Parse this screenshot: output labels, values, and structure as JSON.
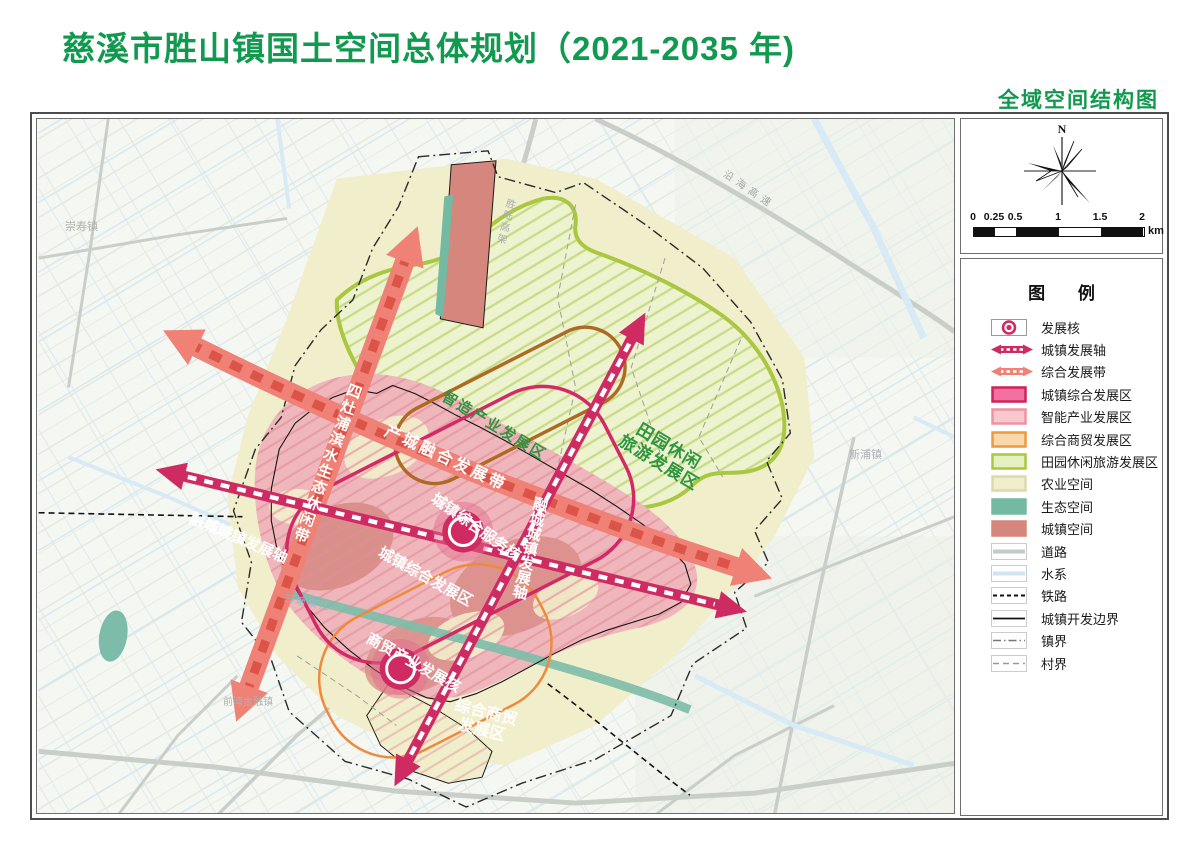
{
  "page": {
    "title": "慈溪市胜山镇国土空间总体规划（2021-2035 年)",
    "subtitle": "全域空间结构图",
    "title_color": "#10994f"
  },
  "panel": {
    "north_label": "N",
    "scale": {
      "ticks": [
        "0",
        "0.25",
        "0.5",
        "1",
        "1.5",
        "2"
      ],
      "tick_px": [
        0,
        21,
        42,
        85,
        127,
        169
      ],
      "segments": [
        {
          "w": 21,
          "c": "#111111"
        },
        {
          "w": 21,
          "c": "#ffffff"
        },
        {
          "w": 43,
          "c": "#111111"
        },
        {
          "w": 42,
          "c": "#ffffff"
        },
        {
          "w": 42,
          "c": "#111111"
        }
      ],
      "unit": "km"
    },
    "legend": {
      "title": "图 例",
      "items": [
        {
          "label": "发展核",
          "type": "core",
          "color": "#cf2a62"
        },
        {
          "label": "城镇发展轴",
          "type": "arrow",
          "color": "#ce2b62"
        },
        {
          "label": "综合发展带",
          "type": "arrow",
          "color": "#ef8177"
        },
        {
          "label": "城镇综合发展区",
          "type": "box",
          "fill": "#f470a0",
          "stroke": "#cf2458"
        },
        {
          "label": "智能产业发展区",
          "type": "box",
          "fill": "#f7c9cf",
          "stroke": "#ee93a4"
        },
        {
          "label": "综合商贸发展区",
          "type": "box",
          "fill": "#f9d9ac",
          "stroke": "#ec9a40"
        },
        {
          "label": "田园休闲旅游发展区",
          "type": "box",
          "fill": "#e5efc2",
          "stroke": "#a9c73f"
        },
        {
          "label": "农业空间",
          "type": "box",
          "fill": "#f1eecb",
          "stroke": "#ddd9ae"
        },
        {
          "label": "生态空间",
          "type": "box",
          "fill": "#74b9a2",
          "stroke": "#74b9a2"
        },
        {
          "label": "城镇空间",
          "type": "box",
          "fill": "#d5867d",
          "stroke": "#d5867d"
        },
        {
          "label": "道路",
          "type": "line",
          "color": "#c6cac6",
          "lw": 4
        },
        {
          "label": "水系",
          "type": "line",
          "color": "#cfe4f0",
          "lw": 4
        },
        {
          "label": "铁路",
          "type": "dash",
          "color": "#111111",
          "lw": 2,
          "dash": "4 3"
        },
        {
          "label": "城镇开发边界",
          "type": "line",
          "color": "#111111",
          "lw": 1.8
        },
        {
          "label": "镇界",
          "type": "dashdot",
          "color": "#777777"
        },
        {
          "label": "村界",
          "type": "dash",
          "color": "#999999",
          "lw": 1.4,
          "dash": "6 4"
        }
      ]
    }
  },
  "map": {
    "labels": [
      {
        "name": "label-sizaopu-belt",
        "text": "四灶浦滨水生态休闲带",
        "x": 312,
        "y": 262,
        "rot": 20,
        "vertical": true,
        "color": "#ffffff",
        "size": 15,
        "spacing": 2
      },
      {
        "name": "label-chancheng-belt",
        "text": "产城融合发展带",
        "x": 352,
        "y": 304,
        "rot": 25,
        "color": "#ffffff",
        "size": 16,
        "spacing": 3
      },
      {
        "name": "label-zhizao-zone",
        "text": "智造产业发展区",
        "x": 410,
        "y": 270,
        "rot": 31,
        "color": "#2f9540",
        "size": 15,
        "spacing": 2
      },
      {
        "name": "label-tianyuan-zone",
        "lines": [
          "田园休闲",
          "旅游发展区"
        ],
        "x": 598,
        "y": 296,
        "rot": 31,
        "color": "#2f9540",
        "size": 17,
        "spacing": 1
      },
      {
        "name": "label-service-core",
        "text": "城镇综合服务核",
        "x": 400,
        "y": 372,
        "rot": 35,
        "color": "#ffffff",
        "size": 15
      },
      {
        "name": "label-urban-zone",
        "text": "城镇综合发展区",
        "x": 346,
        "y": 426,
        "rot": 29,
        "color": "#ffffff",
        "size": 15
      },
      {
        "name": "label-rongcheng-axis-v",
        "text": "融城城镇发展轴",
        "x": 497,
        "y": 376,
        "rot": 13,
        "vertical": true,
        "color": "#ffffff",
        "size": 15
      },
      {
        "name": "label-rongcheng-axis-d",
        "text": "融城城镇发展轴",
        "x": 156,
        "y": 392,
        "rot": 23,
        "color": "#ffffff",
        "size": 15
      },
      {
        "name": "label-trade-core",
        "text": "商贸产业发展核",
        "x": 334,
        "y": 512,
        "rot": 29,
        "color": "#ffffff",
        "size": 15
      },
      {
        "name": "label-trade-zone",
        "lines": [
          "综合商贸",
          "发展区"
        ],
        "x": 420,
        "y": 578,
        "rot": 14,
        "color": "#ffffff",
        "size": 16
      },
      {
        "name": "label-chongshou-town",
        "text": "崇寿镇",
        "x": 28,
        "y": 102,
        "rot": 0,
        "color": "#aeb2ae",
        "size": 11,
        "bold": false
      },
      {
        "name": "label-yanhai-expressway",
        "text": "沿海高速",
        "x": 690,
        "y": 50,
        "rot": 34,
        "color": "#a2a8a6",
        "size": 10,
        "bold": false,
        "spacing": 5
      },
      {
        "name": "label-shenglu-viaduct",
        "text": "胜陆高架",
        "x": 468,
        "y": 78,
        "rot": 14,
        "vertical": true,
        "color": "#a8adad",
        "size": 10,
        "bold": false,
        "spacing": 2
      },
      {
        "name": "label-xinpu-town",
        "text": "新浦镇",
        "x": 812,
        "y": 330,
        "rot": 0,
        "color": "#aeb2b6",
        "size": 11,
        "bold": false
      },
      {
        "name": "label-santang-river",
        "text": "三塘横江",
        "x": 248,
        "y": 474,
        "rot": 12,
        "color": "#93b9c9",
        "size": 10,
        "bold": false,
        "spacing": 2
      },
      {
        "name": "label-qianwan",
        "text": "前湾金融镇",
        "x": 186,
        "y": 578,
        "rot": 0,
        "color": "#aeb2ae",
        "size": 10,
        "bold": false
      }
    ],
    "colors": {
      "axis_crimson": "#ce2b62",
      "belt_salmon": "#ef8177",
      "belt_dash": "#dc5448",
      "urban_pink": "#efb7bc",
      "pink_hatch": "#e28d98",
      "agri_cream": "#f1eecb",
      "eco_teal": "#74b9a2",
      "town_red": "#d5867d",
      "green_zone_fill": "#edf2cf",
      "green_zone_border": "#a9c73f",
      "brown_outline": "#ad6a22",
      "orange_outline": "#ef8a3c",
      "core_crimson": "#cf2a62"
    }
  }
}
